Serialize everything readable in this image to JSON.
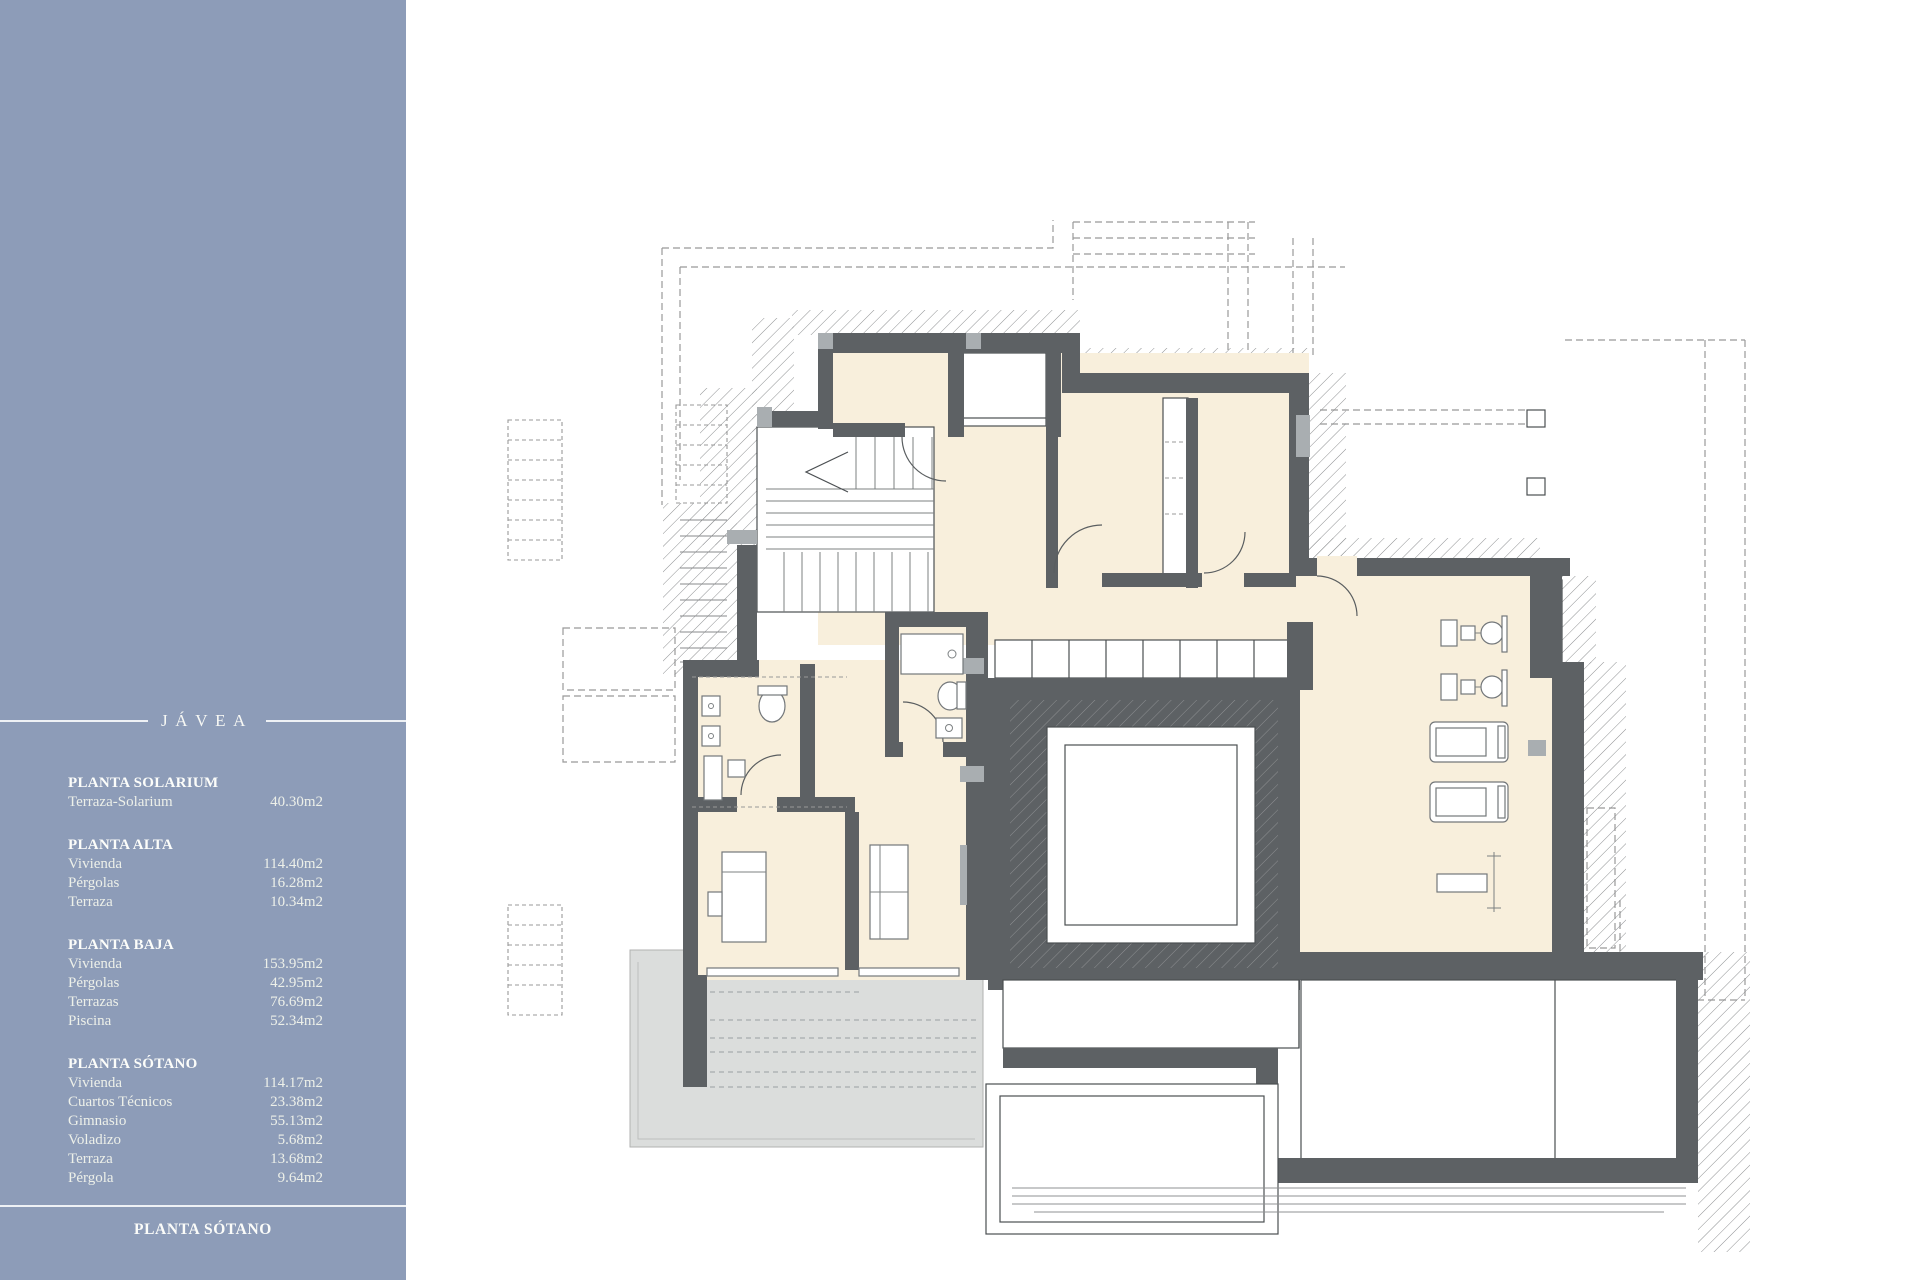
{
  "sidebar": {
    "title": "JÁVEA",
    "bg_color": "#8d9cb8",
    "text_color": "#f2f4ee",
    "sections": [
      {
        "heading": "PLANTA SOLARIUM",
        "rows": [
          {
            "label": "Terraza-Solarium",
            "value": "40.30m2"
          }
        ]
      },
      {
        "heading": "PLANTA ALTA",
        "rows": [
          {
            "label": "Vivienda",
            "value": "114.40m2"
          },
          {
            "label": "Pérgolas",
            "value": "16.28m2"
          },
          {
            "label": "Terraza",
            "value": "10.34m2"
          }
        ]
      },
      {
        "heading": "PLANTA BAJA",
        "rows": [
          {
            "label": "Vivienda",
            "value": "153.95m2"
          },
          {
            "label": "Pérgolas",
            "value": "42.95m2"
          },
          {
            "label": "Terrazas",
            "value": "76.69m2"
          },
          {
            "label": "Piscina",
            "value": "52.34m2"
          }
        ]
      },
      {
        "heading": "PLANTA SÓTANO",
        "rows": [
          {
            "label": "Vivienda",
            "value": "114.17m2"
          },
          {
            "label": "Cuartos Técnicos",
            "value": "23.38m2"
          },
          {
            "label": "Gimnasio",
            "value": "55.13m2"
          },
          {
            "label": "Voladizo",
            "value": "5.68m2"
          },
          {
            "label": "Terraza",
            "value": "13.68m2"
          },
          {
            "label": "Pérgola",
            "value": "9.64m2"
          }
        ]
      }
    ],
    "footer_label": "PLANTA SÓTANO"
  },
  "plan": {
    "colors": {
      "wall": "#5d6164",
      "room_fill": "#f8efdc",
      "deck_fill": "#dbdddc",
      "pad_fill": "#a9aeb1",
      "hatch_line": "#8e9092",
      "dashed_line": "#999999",
      "outline": "#4b4f52"
    },
    "features": [
      "projection-dashed-lines",
      "ground-hatch",
      "exterior-stair",
      "stairs-icon",
      "door-arc-icon",
      "glass-wall-band",
      "courtyard-lightwell",
      "toilet-icon",
      "sink-icon",
      "shower-icon",
      "bed-icon",
      "nightstand-icon",
      "sofa-icon",
      "closet-shelves",
      "gym-machine-icon",
      "treadmill-icon",
      "bench-press-icon",
      "terrace-deck",
      "pool-deck",
      "pergola-posts"
    ]
  }
}
